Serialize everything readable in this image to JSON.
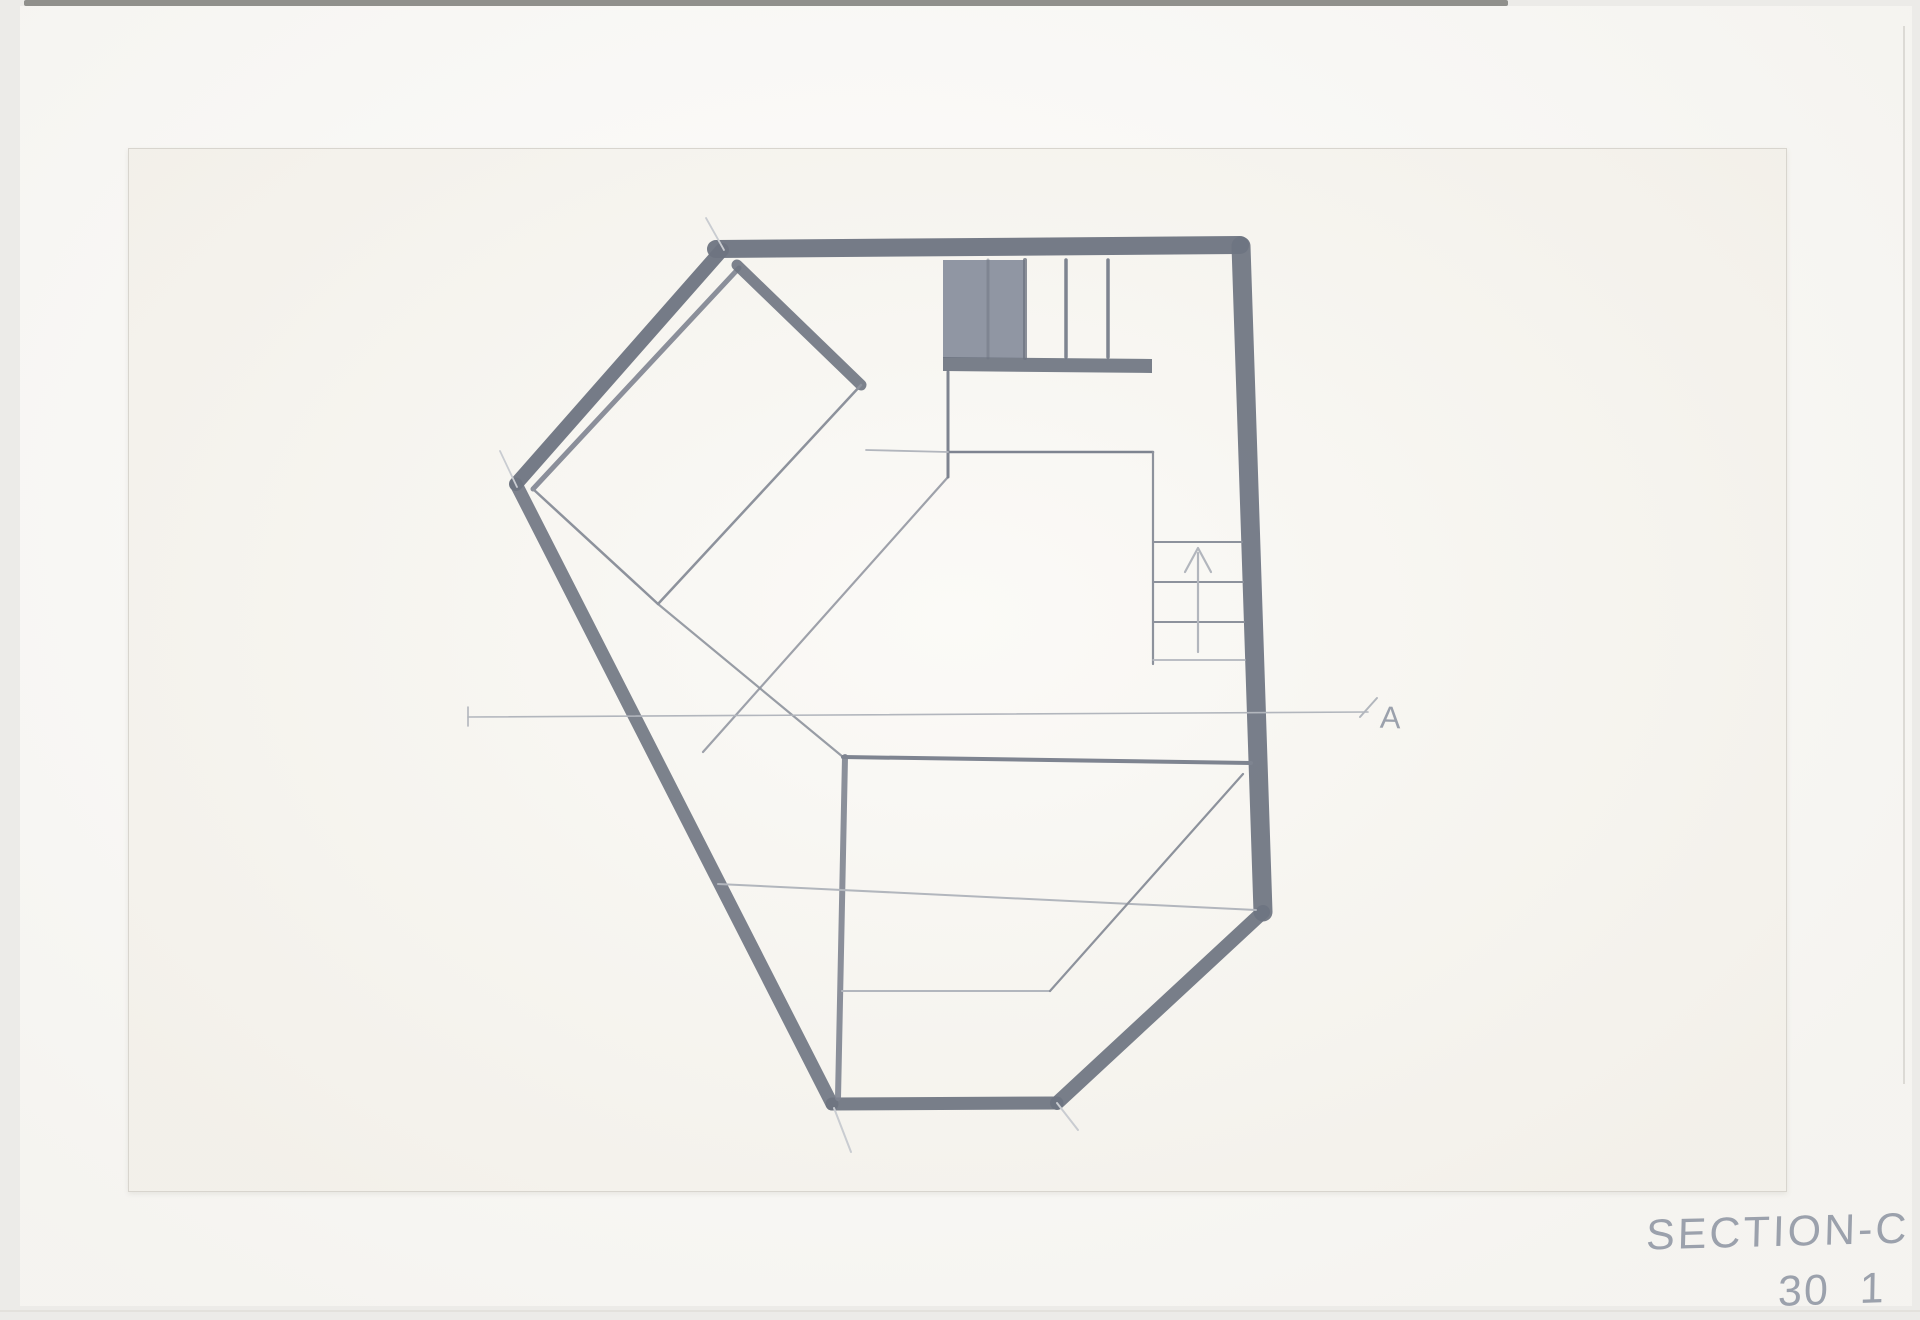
{
  "annotations": {
    "title": "SECTION-C",
    "sheet_number": "30 1",
    "section_marker": "A"
  },
  "palette": {
    "photo_bg": "#ecebe8",
    "backing_paper": "#fbfaf7",
    "sheet_paper": "#f7f5ef",
    "ink_dark": "#6e7481",
    "ink_med": "#7e8490",
    "ink_thin": "#8d929c",
    "ink_faint": "#b2b6bd",
    "ink_xfaint": "#c9ccd1",
    "panel_fill": "#8a909e",
    "pencil_text": "#9ba1ac"
  },
  "drawing": {
    "canvas": {
      "width": 1920,
      "height": 1320
    },
    "strokes": [
      {
        "name": "wall-top",
        "type": "polyline",
        "points": [
          [
            716,
            249
          ],
          [
            1240,
            245
          ]
        ],
        "width": 18,
        "color": "ink_dark",
        "opacity": 0.95
      },
      {
        "name": "wall-right",
        "type": "polyline",
        "points": [
          [
            1241,
            246
          ],
          [
            1263,
            912
          ]
        ],
        "width": 19,
        "color": "ink_dark",
        "opacity": 0.93
      },
      {
        "name": "wall-lower-right-diagonal",
        "type": "polyline",
        "points": [
          [
            1263,
            912
          ],
          [
            1057,
            1103
          ]
        ],
        "width": 14,
        "color": "ink_dark",
        "opacity": 0.93
      },
      {
        "name": "wall-bottom",
        "type": "polyline",
        "points": [
          [
            1057,
            1103
          ],
          [
            832,
            1104
          ]
        ],
        "width": 13,
        "color": "ink_dark",
        "opacity": 0.93
      },
      {
        "name": "wall-lower-left",
        "type": "polyline",
        "points": [
          [
            832,
            1104
          ],
          [
            516,
            484
          ]
        ],
        "width": 13,
        "color": "ink_dark",
        "opacity": 0.9
      },
      {
        "name": "wall-upper-left",
        "type": "polyline",
        "points": [
          [
            516,
            484
          ],
          [
            722,
            250
          ]
        ],
        "width": 14,
        "color": "ink_dark",
        "opacity": 0.95
      },
      {
        "name": "wall-upper-left-inner-face",
        "type": "polyline",
        "points": [
          [
            739,
            268
          ],
          [
            533,
            489
          ]
        ],
        "width": 5,
        "color": "ink_med",
        "opacity": 0.9
      },
      {
        "name": "roof-beam-diagonal",
        "type": "polyline",
        "points": [
          [
            737,
            265
          ],
          [
            861,
            385
          ]
        ],
        "width": 11,
        "color": "ink_dark",
        "opacity": 0.9
      },
      {
        "name": "loft-room-edge-right",
        "type": "polyline",
        "points": [
          [
            861,
            385
          ],
          [
            658,
            604
          ]
        ],
        "width": 2.5,
        "color": "ink_thin"
      },
      {
        "name": "loft-room-edge-left",
        "type": "polyline",
        "points": [
          [
            533,
            489
          ],
          [
            658,
            604
          ]
        ],
        "width": 2.5,
        "color": "ink_thin"
      },
      {
        "name": "interior-diagonal-a",
        "type": "polyline",
        "points": [
          [
            948,
            477
          ],
          [
            703,
            752
          ]
        ],
        "width": 2.2,
        "color": "ink_thin",
        "opacity": 0.85
      },
      {
        "name": "interior-diagonal-b",
        "type": "polyline",
        "points": [
          [
            658,
            604
          ],
          [
            843,
            757
          ]
        ],
        "width": 2.2,
        "color": "ink_thin",
        "opacity": 0.9
      },
      {
        "name": "window-jamb-vertical",
        "type": "polyline",
        "points": [
          [
            948,
            372
          ],
          [
            948,
            477
          ]
        ],
        "width": 3,
        "color": "ink_med"
      },
      {
        "name": "upper-floor-line",
        "type": "polyline",
        "points": [
          [
            948,
            452
          ],
          [
            1153,
            452
          ]
        ],
        "width": 2.5,
        "color": "ink_med"
      },
      {
        "name": "upper-floor-line-extension",
        "type": "polyline",
        "points": [
          [
            866,
            450
          ],
          [
            948,
            452
          ]
        ],
        "width": 1.8,
        "color": "ink_faint"
      },
      {
        "name": "stair-well-vertical",
        "type": "polyline",
        "points": [
          [
            1153,
            452
          ],
          [
            1153,
            664
          ]
        ],
        "width": 2.2,
        "color": "ink_thin"
      },
      {
        "name": "stair-tread-1",
        "type": "polyline",
        "points": [
          [
            1153,
            542
          ],
          [
            1242,
            542
          ]
        ],
        "width": 2,
        "color": "ink_thin"
      },
      {
        "name": "stair-tread-2",
        "type": "polyline",
        "points": [
          [
            1153,
            582
          ],
          [
            1243,
            582
          ]
        ],
        "width": 2,
        "color": "ink_thin"
      },
      {
        "name": "stair-tread-3",
        "type": "polyline",
        "points": [
          [
            1153,
            622
          ],
          [
            1244,
            622
          ]
        ],
        "width": 2,
        "color": "ink_thin"
      },
      {
        "name": "stair-tread-4",
        "type": "polyline",
        "points": [
          [
            1153,
            660
          ],
          [
            1245,
            660
          ]
        ],
        "width": 1.8,
        "color": "ink_faint"
      },
      {
        "name": "stair-arrow-shaft",
        "type": "polyline",
        "points": [
          [
            1198,
            652
          ],
          [
            1198,
            553
          ]
        ],
        "width": 2.2,
        "color": "ink_faint"
      },
      {
        "name": "stair-arrow-head",
        "type": "polyline",
        "points": [
          [
            1185,
            572
          ],
          [
            1198,
            548
          ],
          [
            1211,
            572
          ]
        ],
        "width": 2.2,
        "color": "ink_faint"
      },
      {
        "name": "window-panel-solid",
        "type": "polygon",
        "points": [
          [
            943,
            260
          ],
          [
            1025,
            260
          ],
          [
            1025,
            358
          ],
          [
            943,
            358
          ]
        ],
        "fill": "panel_fill",
        "width": 0,
        "opacity": 0.95
      },
      {
        "name": "window-panel-seam",
        "type": "polyline",
        "points": [
          [
            988,
            260
          ],
          [
            988,
            358
          ]
        ],
        "width": 3,
        "color": "ink_dark",
        "opacity": 0.5
      },
      {
        "name": "window-panel-edge",
        "type": "polyline",
        "points": [
          [
            1025,
            260
          ],
          [
            1025,
            358
          ]
        ],
        "width": 4,
        "color": "ink_dark",
        "opacity": 0.8
      },
      {
        "name": "window-mullion-1",
        "type": "polyline",
        "points": [
          [
            1066,
            260
          ],
          [
            1066,
            357
          ]
        ],
        "width": 3.5,
        "color": "ink_med"
      },
      {
        "name": "window-mullion-2",
        "type": "polyline",
        "points": [
          [
            1108,
            260
          ],
          [
            1108,
            357
          ]
        ],
        "width": 3.5,
        "color": "ink_med"
      },
      {
        "name": "window-sill-band",
        "type": "polygon",
        "points": [
          [
            943,
            357
          ],
          [
            1152,
            359
          ],
          [
            1152,
            373
          ],
          [
            943,
            371
          ]
        ],
        "fill": "ink_dark",
        "width": 0,
        "opacity": 0.92
      },
      {
        "name": "mid-floor-ledge",
        "type": "polyline",
        "points": [
          [
            843,
            757
          ],
          [
            1251,
            763
          ]
        ],
        "width": 4,
        "color": "ink_med"
      },
      {
        "name": "mid-vertical-post",
        "type": "polyline",
        "points": [
          [
            845,
            757
          ],
          [
            838,
            1098
          ]
        ],
        "width": 6,
        "color": "ink_med",
        "opacity": 0.9
      },
      {
        "name": "lower-floor-faint",
        "type": "polyline",
        "points": [
          [
            718,
            884
          ],
          [
            1256,
            910
          ]
        ],
        "width": 2,
        "color": "ink_faint"
      },
      {
        "name": "basement-floor-faint",
        "type": "polyline",
        "points": [
          [
            842,
            991
          ],
          [
            1050,
            991
          ]
        ],
        "width": 2,
        "color": "ink_faint"
      },
      {
        "name": "basement-diagonal",
        "type": "polyline",
        "points": [
          [
            1243,
            774
          ],
          [
            1050,
            991
          ]
        ],
        "width": 2.2,
        "color": "ink_thin"
      },
      {
        "name": "section-cut-line",
        "type": "polyline",
        "points": [
          [
            468,
            717
          ],
          [
            1368,
            712
          ]
        ],
        "width": 1.6,
        "color": "ink_faint"
      },
      {
        "name": "section-cut-tick-left",
        "type": "polyline",
        "points": [
          [
            468,
            707
          ],
          [
            468,
            726
          ]
        ],
        "width": 1.6,
        "color": "ink_faint"
      },
      {
        "name": "section-cut-tick-right",
        "type": "polyline",
        "points": [
          [
            1360,
            717
          ],
          [
            1377,
            698
          ]
        ],
        "width": 2,
        "color": "ink_faint"
      },
      {
        "name": "construction-overshoot-apex",
        "type": "polyline",
        "points": [
          [
            706,
            218
          ],
          [
            724,
            250
          ]
        ],
        "width": 1.8,
        "color": "ink_xfaint"
      },
      {
        "name": "construction-overshoot-left-corner",
        "type": "polyline",
        "points": [
          [
            500,
            451
          ],
          [
            517,
            487
          ]
        ],
        "width": 1.8,
        "color": "ink_xfaint"
      },
      {
        "name": "construction-overshoot-bottom-left",
        "type": "polyline",
        "points": [
          [
            834,
            1108
          ],
          [
            851,
            1152
          ]
        ],
        "width": 2,
        "color": "ink_xfaint"
      },
      {
        "name": "construction-overshoot-bottom-right",
        "type": "polyline",
        "points": [
          [
            1057,
            1103
          ],
          [
            1078,
            1130
          ]
        ],
        "width": 2,
        "color": "ink_xfaint"
      }
    ]
  }
}
